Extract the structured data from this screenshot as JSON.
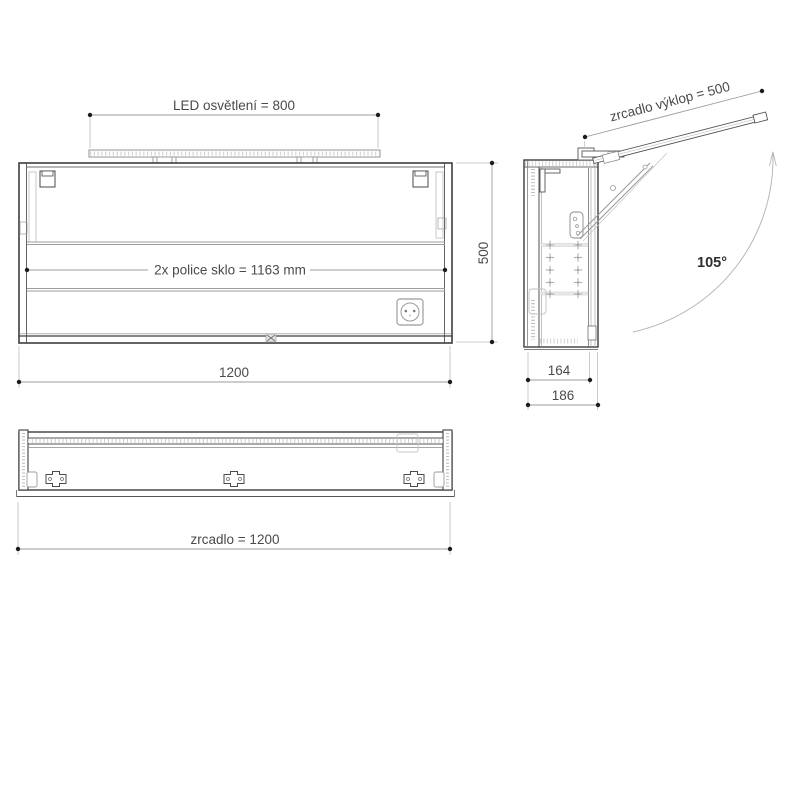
{
  "drawing_title": "mirror cabinet technical drawing (three views)",
  "colors": {
    "background": "#ffffff",
    "outline_dark": "#3d3d3d",
    "outline_mid": "#6e6e6e",
    "detail_light": "#c2c2c2",
    "dimension_line": "#9b9b9b",
    "dimension_dot": "#1c1c1c",
    "text": "#4a4a4a"
  },
  "front_view": {
    "led_dim_label": "LED osvětlení = 800",
    "shelf_dim_label": "2x  police sklo = 1163 mm",
    "width_dim_label": "1200",
    "height_dim_label": "500",
    "icons": [
      "power-socket-icon",
      "led-strip-icon",
      "door-clip-icon"
    ]
  },
  "side_view": {
    "tilt_dim_label": "zrcadlo výklop = 500",
    "angle_label": "105°",
    "inner_depth_dim_label": "164",
    "outer_depth_dim_label": "186",
    "icons": [
      "hinge-plate-icon",
      "shelf-pin-icon",
      "gas-strut-icon",
      "swing-arc-arrow-icon"
    ]
  },
  "bottom_view": {
    "width_dim_label": "zrcadlo = 1200",
    "icons": [
      "mounting-bracket-icon"
    ]
  }
}
